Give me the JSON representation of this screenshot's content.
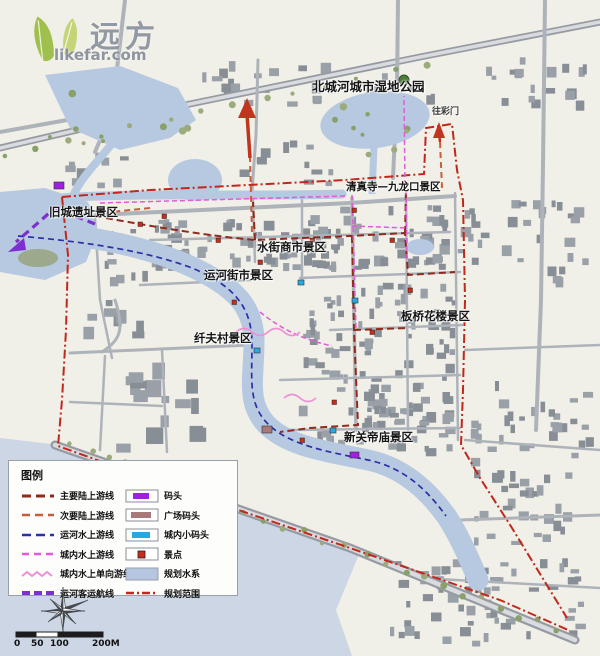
{
  "watermark": {
    "brand": "远方",
    "site": "likefar.com"
  },
  "map_labels": {
    "wetland_park": "北城河城市湿地公园",
    "to_gate": "往彩门",
    "mosque_jiulongkou": "清真寺—九龙口景区",
    "old_city_ruins": "旧城遗址景区",
    "water_street_market": "水街商市景区",
    "canal_street_market": "运河街市景区",
    "banqiao_flower": "板桥花楼景区",
    "fiber_village": "纤夫村景区",
    "new_guandi_temple": "新关帝庙景区"
  },
  "legend": {
    "title": "图例",
    "line_items": [
      {
        "label": "主要陆上游线",
        "color": "#8f2a1c"
      },
      {
        "label": "次要陆上游线",
        "color": "#c95f3a"
      },
      {
        "label": "运河水上游线",
        "color": "#2b2fa8"
      },
      {
        "label": "城内水上游线",
        "color": "#e05cd8"
      },
      {
        "label": "城内水上单向游线",
        "color": "#ef8fd8"
      },
      {
        "label": "运河客运航线",
        "color": "#7e2fd0"
      }
    ],
    "symbol_items": [
      {
        "label": "码头",
        "color": "#a020e0"
      },
      {
        "label": "广场码头",
        "color": "#a8787a"
      },
      {
        "label": "城内小码头",
        "color": "#29a8e0"
      },
      {
        "label": "景点",
        "color": "#cc2a1a"
      },
      {
        "label": "规划水系",
        "color": "#b6c6e0"
      },
      {
        "label": "规划范围",
        "color": "#c1271b"
      }
    ]
  },
  "scalebar": {
    "ticks": [
      "0",
      "50",
      "100",
      "200M"
    ]
  },
  "colors": {
    "main_route": "#8f2a1c",
    "secondary_route": "#c95f3a",
    "canal_water_route": "#2b2fa8",
    "city_water_route": "#e05cd8",
    "oneway_route": "#ef8fd8",
    "passenger_route": "#7e2fd0",
    "boundary": "#c1271b",
    "water": "#b7c9e0",
    "arrow": "#c1351f"
  }
}
